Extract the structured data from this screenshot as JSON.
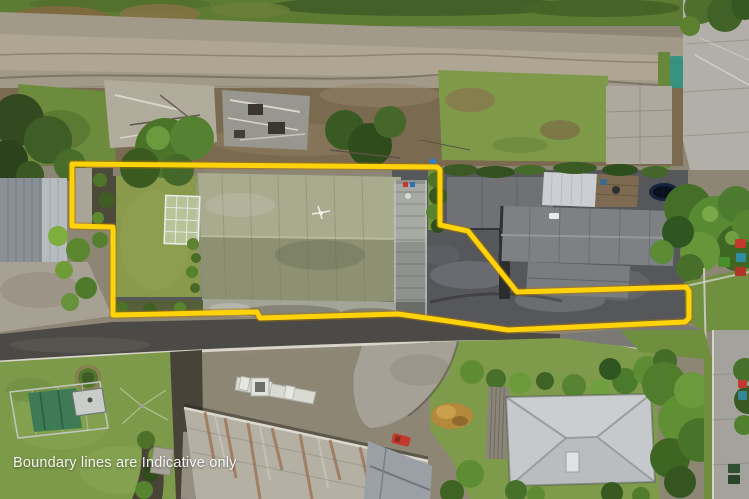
{
  "watermark": {
    "text": "Boundary lines are Indicative only",
    "color": "#f2f2ee"
  },
  "boundary": {
    "color": "#FFD30A",
    "halo_color": "rgba(170,115,0,0.45)",
    "points": "72,164 437,167 440,170 440,225 468,231 509,282 517,292 686,287 689,291 689,318 685,322 508,330 441,320 398,314 260,318 257,312 113,315 113,227 72,226"
  },
  "colors": {
    "dirt_road": "#a19a89",
    "bank": "#7a6a50",
    "lawn": "#8a9a4d",
    "subject_roof_north": "#a9ab8f",
    "subject_roof_south": "#8d9172",
    "garage_roof": "#6f7175",
    "neighbor_roof": "#7d8184",
    "white_garage_roof": "#cbced2",
    "asphalt": "#56575b",
    "street": "#4c4a46",
    "kerb": "#d8d4ca",
    "concrete_drive": "#b2afa8",
    "rusty_roof": "#b4b0a4",
    "hip_roof": "#c5c9cc",
    "grass_front": "#7d9a4a",
    "tarp": "#3e7a55",
    "trampoline": "#16243f",
    "ball": "#2b7fd6"
  }
}
